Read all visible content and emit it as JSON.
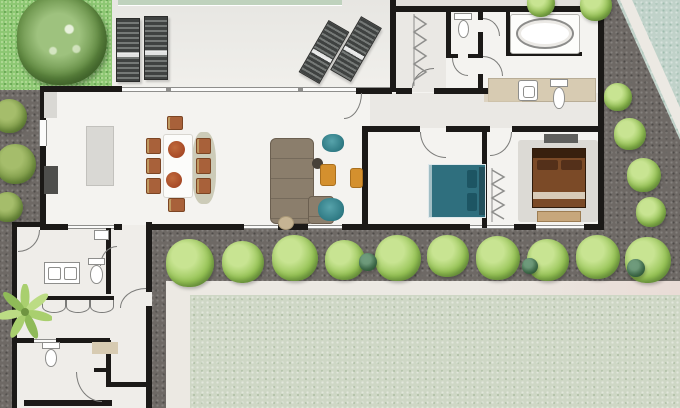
{
  "scene": {
    "type": "architectural-floor-plan",
    "style": "top-down watercolor villa plan with garden, gravel paths, hedges and lawn",
    "canvas": {
      "width": 680,
      "height": 408
    }
  },
  "palette": {
    "bg": "#e2dfdb",
    "grass": "#8cc772",
    "grassDot": "#aed993",
    "treeLight": "#9ec27e",
    "treeMid": "#628b42",
    "treeDark": "#46682f",
    "pool": "#bfd2bd",
    "patio": "#e7e6e2",
    "patioLight": "#f1f0ec",
    "lounger": "#3f4241",
    "loungerSlat": "#757977",
    "gravel": "#6e6965",
    "lawn": "#ced7c5",
    "strip": "#ece9e3",
    "stripPink": "#e9dcd6",
    "tealCorner": "#c0d2c9",
    "wall": "#1b1917",
    "floor": "#f4f3f0",
    "hallShade": "#eaE8e4",
    "wingFloor": "#efede9",
    "wallGray": "#8e8e8c",
    "arc": "#7b7b79",
    "win": "#fbfbfa",
    "fixture": "#ffffff",
    "fixtureLine": "#8e8e8c",
    "counter": "#d7cbb2",
    "island": "#d9d8d4",
    "appliance": "#4e4e4c",
    "table": "#fcfcfa",
    "chairRust": "#a8613a",
    "chairTan": "#c09b62",
    "bowl": "#9c3c1d",
    "sofa": "#8b7e6c",
    "sofaDark": "#6b5f50",
    "ottoman": "#c6b493",
    "teal": "#2f7a84",
    "tealDark": "#1d5563",
    "tealBed": "#2f6f7e",
    "tealBedDark": "#23505c",
    "pillowTeal": "#1d5563",
    "orange": "#d4902e",
    "orangeDark": "#a96f1e",
    "bed2": "#7b4a27",
    "bed2Dark": "#38200e",
    "pillow2": "#54301a",
    "bed2Fold": "#d8cbb8",
    "bench": "#c7a77c",
    "rug": "#dcdad5",
    "tv": "#5f5f5d",
    "bushLight": "#c8e492",
    "bushMid": "#96c355",
    "bushDark": "#5e8a38",
    "oliveLight": "#a5bd6b",
    "oliveMid": "#7d9a47",
    "oliveDark": "#55722f",
    "bushTeal": "#3c6b52",
    "palmLeaf": "#a9cf6e",
    "palmCore": "#6f9440"
  },
  "vegetation": {
    "tree": {
      "x": 62,
      "y": 40,
      "r": 45
    },
    "palm": {
      "x": 24,
      "y": 312,
      "size": 54
    },
    "left_column": [
      {
        "x": 10,
        "y": 116,
        "r": 17
      },
      {
        "x": 16,
        "y": 164,
        "r": 20
      },
      {
        "x": 8,
        "y": 207,
        "r": 15
      }
    ],
    "bottom_row": [
      {
        "x": 190,
        "y": 263,
        "r": 24
      },
      {
        "x": 243,
        "y": 262,
        "r": 21
      },
      {
        "x": 295,
        "y": 258,
        "r": 23
      },
      {
        "x": 345,
        "y": 260,
        "r": 20
      },
      {
        "x": 398,
        "y": 258,
        "r": 23
      },
      {
        "x": 448,
        "y": 256,
        "r": 21
      },
      {
        "x": 498,
        "y": 258,
        "r": 22
      },
      {
        "x": 548,
        "y": 260,
        "r": 21
      },
      {
        "x": 598,
        "y": 257,
        "r": 22
      },
      {
        "x": 648,
        "y": 260,
        "r": 23
      }
    ],
    "dark_accents": [
      {
        "x": 368,
        "y": 262,
        "r": 9
      },
      {
        "x": 530,
        "y": 266,
        "r": 8
      },
      {
        "x": 636,
        "y": 268,
        "r": 9
      }
    ],
    "right_column": [
      {
        "x": 618,
        "y": 97,
        "r": 14
      },
      {
        "x": 630,
        "y": 134,
        "r": 16
      },
      {
        "x": 644,
        "y": 175,
        "r": 17
      },
      {
        "x": 651,
        "y": 212,
        "r": 15
      }
    ],
    "top_edge": [
      {
        "x": 541,
        "y": 3,
        "r": 14
      },
      {
        "x": 596,
        "y": 5,
        "r": 16
      }
    ]
  },
  "furnishings": [
    "four sun loungers on patio",
    "dining table with eight chairs and two bowls",
    "kitchen island and dark appliance",
    "L-shaped sectional sofa with ottoman",
    "two teal armchairs",
    "two orange armchairs",
    "round side table",
    "teal double bed",
    "brown double bed with foot bench on rug",
    "oval bathtub on platform",
    "vanity counter with basin and toilet",
    "guest WC toilets",
    "double-sink vanity",
    "wardrobes with hanger symbols",
    "hedge bushes",
    "large tree",
    "palm plant",
    "lawn panel",
    "gravel paths"
  ]
}
